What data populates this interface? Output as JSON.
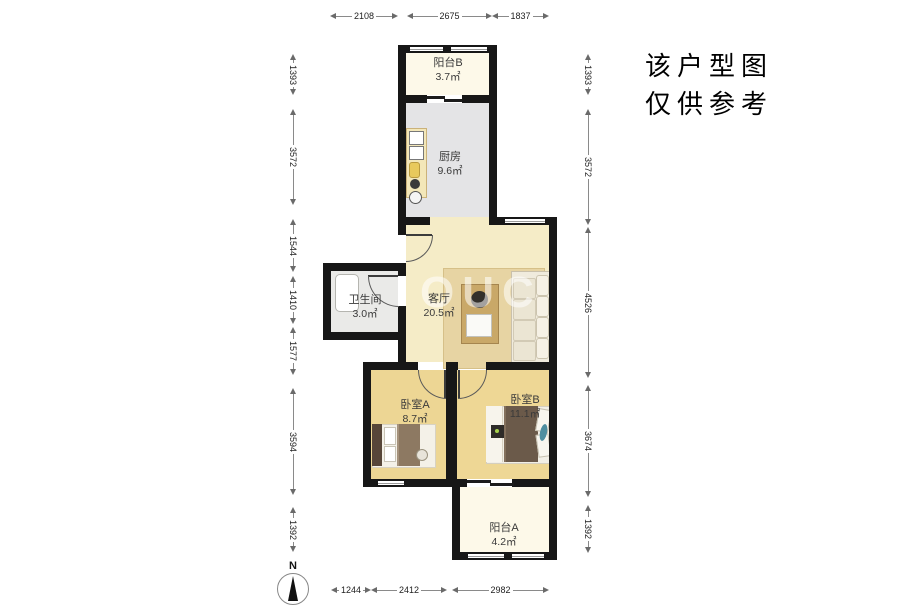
{
  "note": {
    "line1": "该户型图",
    "line2": "仅供参考"
  },
  "compass": {
    "north": "N"
  },
  "watermark": "OUC",
  "rooms": {
    "balcony_b": {
      "name": "阳台B",
      "area": "3.7㎡"
    },
    "kitchen": {
      "name": "厨房",
      "area": "9.6㎡"
    },
    "bathroom": {
      "name": "卫生间",
      "area": "3.0㎡"
    },
    "living_room": {
      "name": "客厅",
      "area": "20.5㎡"
    },
    "bedroom_a": {
      "name": "卧室A",
      "area": "8.7㎡"
    },
    "bedroom_b": {
      "name": "卧室B",
      "area": "11.1㎡"
    },
    "balcony_a": {
      "name": "阳台A",
      "area": "4.2㎡"
    }
  },
  "dims": {
    "top": [
      "2108",
      "2675",
      "1837"
    ],
    "left": [
      "1393",
      "3572",
      "1544",
      "1410",
      "1577",
      "3594",
      "1392"
    ],
    "right": [
      "1393",
      "3572",
      "4526",
      "3674",
      "1392"
    ],
    "bottom": [
      "1244",
      "2412",
      "2982"
    ]
  },
  "colors": {
    "wall": "#171717",
    "living_floor": "#f5ecc7",
    "bedroom_floor": "#edd694",
    "kitchen_floor": "#e4e4e6",
    "balcony_floor": "#fdf9e9",
    "bathroom_floor": "#eaeae8"
  }
}
